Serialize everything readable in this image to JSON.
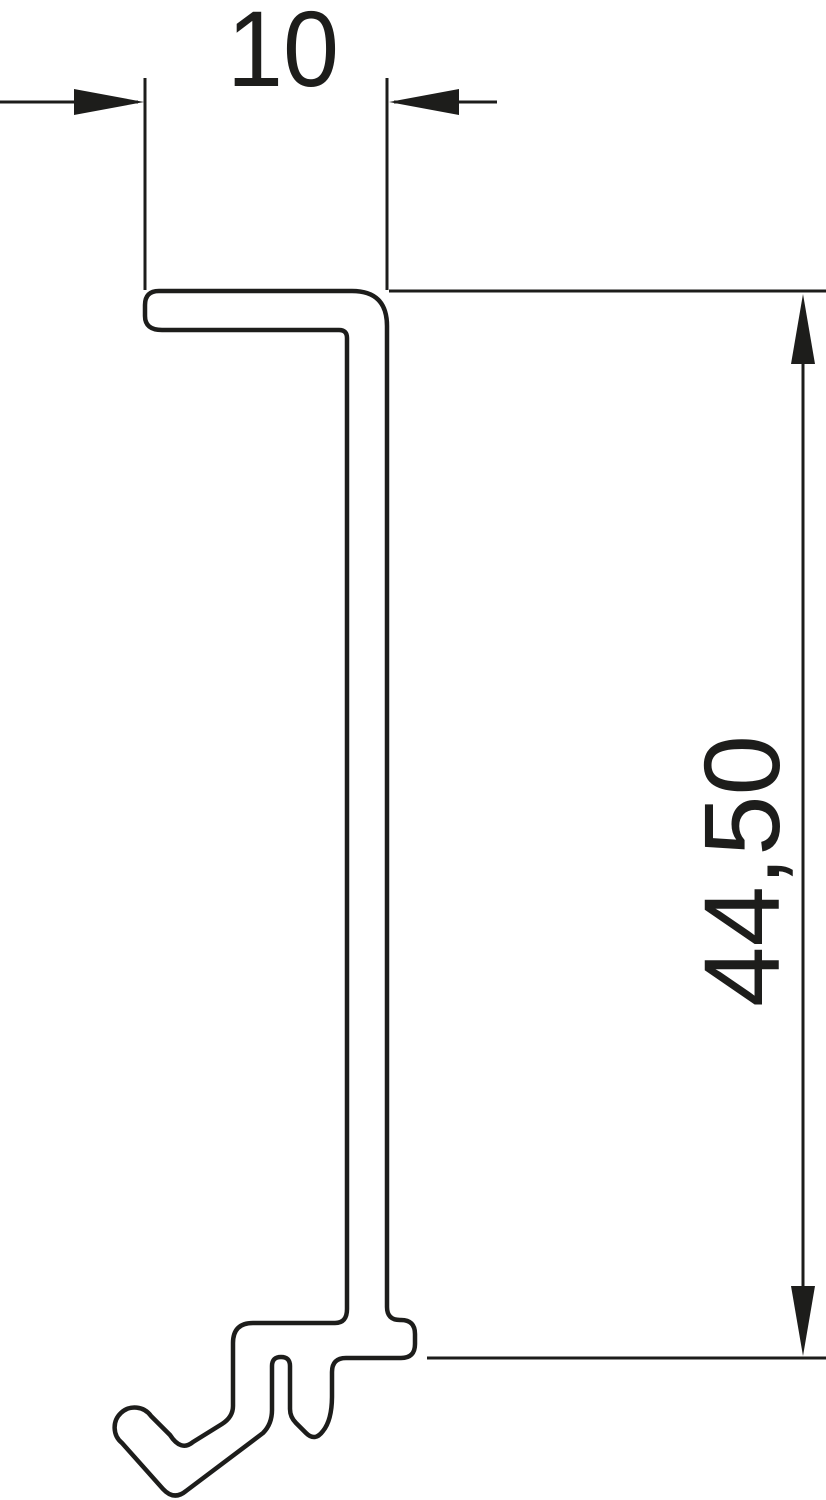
{
  "drawing": {
    "background_color": "#ffffff",
    "line_color": "#1d1d1b",
    "fill_color": "#ffffff"
  },
  "dimensions": {
    "width": {
      "label": "10"
    },
    "height": {
      "label": "44,50"
    }
  }
}
